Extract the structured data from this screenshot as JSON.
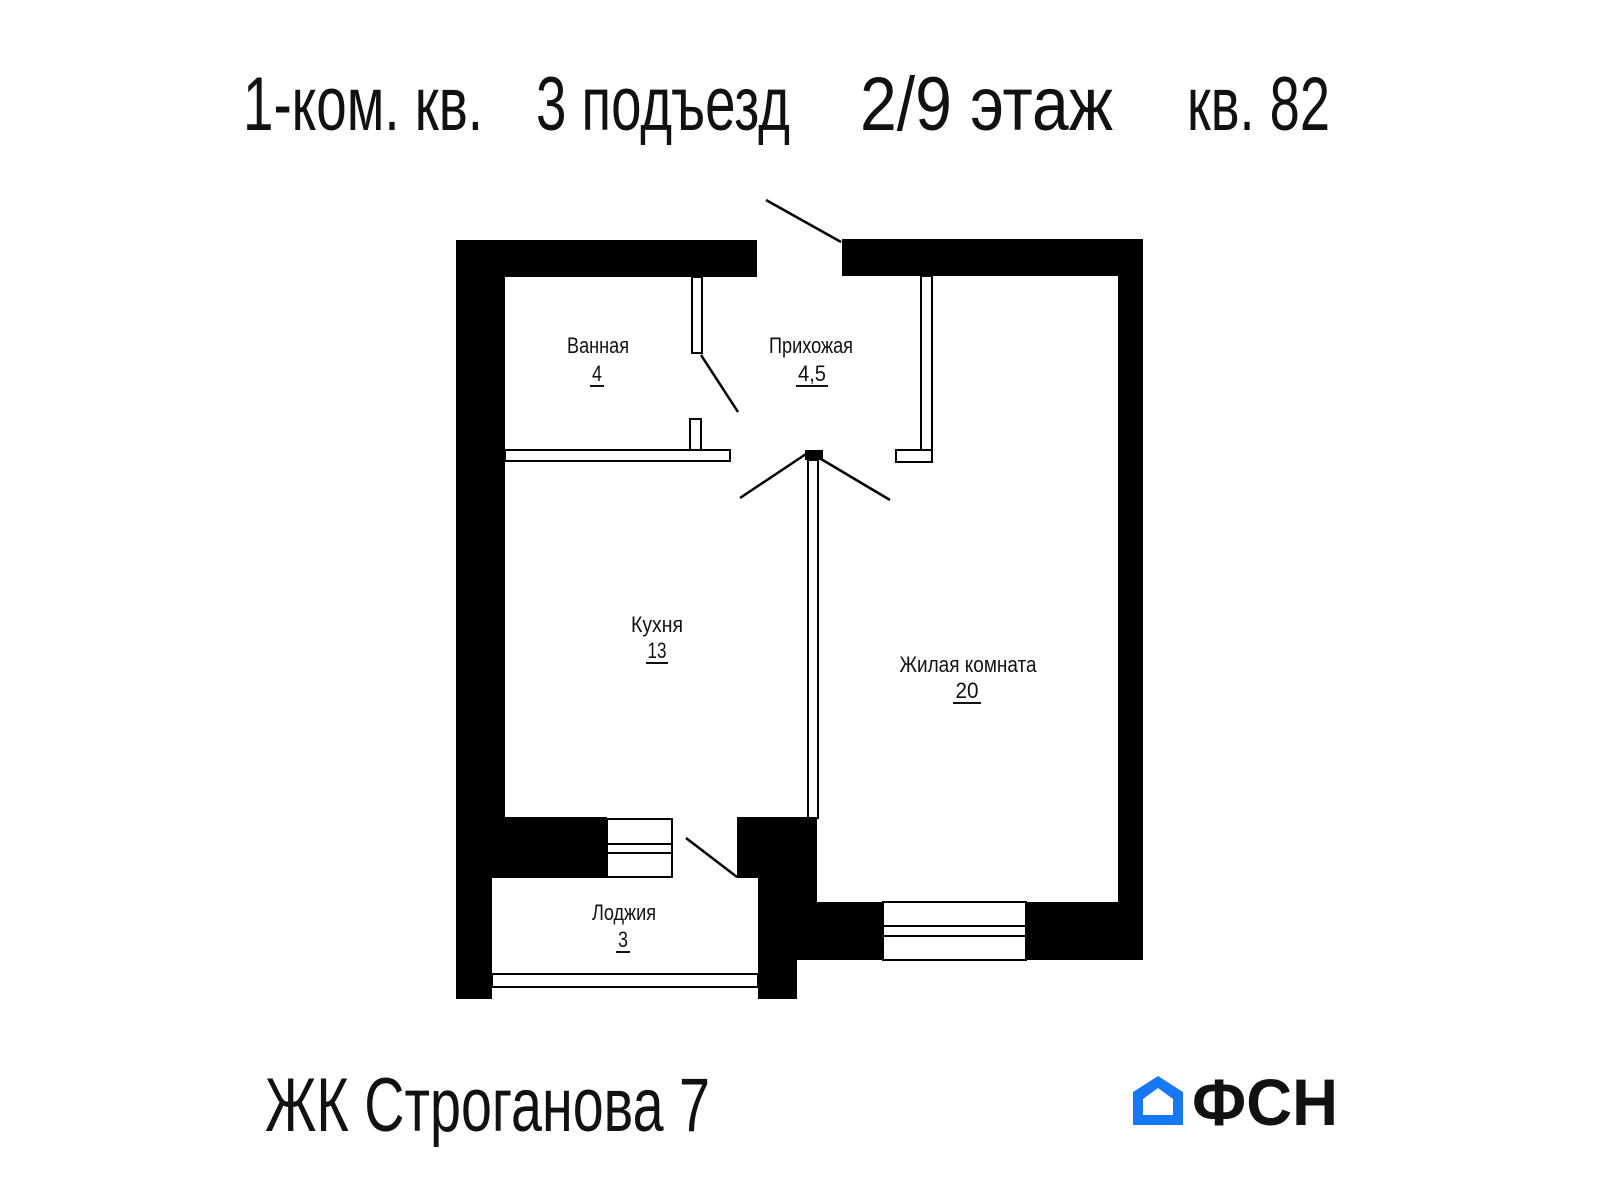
{
  "title": {
    "segments": [
      "1-ком. кв.",
      "3 подъезд",
      "2/9 этаж",
      "кв. 82"
    ]
  },
  "rooms": [
    {
      "name": "Ванная",
      "area": "4"
    },
    {
      "name": "Прихожая",
      "area": "4,5"
    },
    {
      "name": "Кухня",
      "area": "13"
    },
    {
      "name": "Жилая комната",
      "area": "20"
    },
    {
      "name": "Лоджия",
      "area": "3"
    }
  ],
  "footer": {
    "complex_name": "ЖК Строганова 7",
    "logo_text": "ФСН"
  },
  "icons": {
    "logo_house": "house-icon"
  },
  "colors": {
    "line": "#000000",
    "background": "#ffffff",
    "logo_blue": "#1677f7",
    "logo_dark": "#2b2b2b"
  }
}
